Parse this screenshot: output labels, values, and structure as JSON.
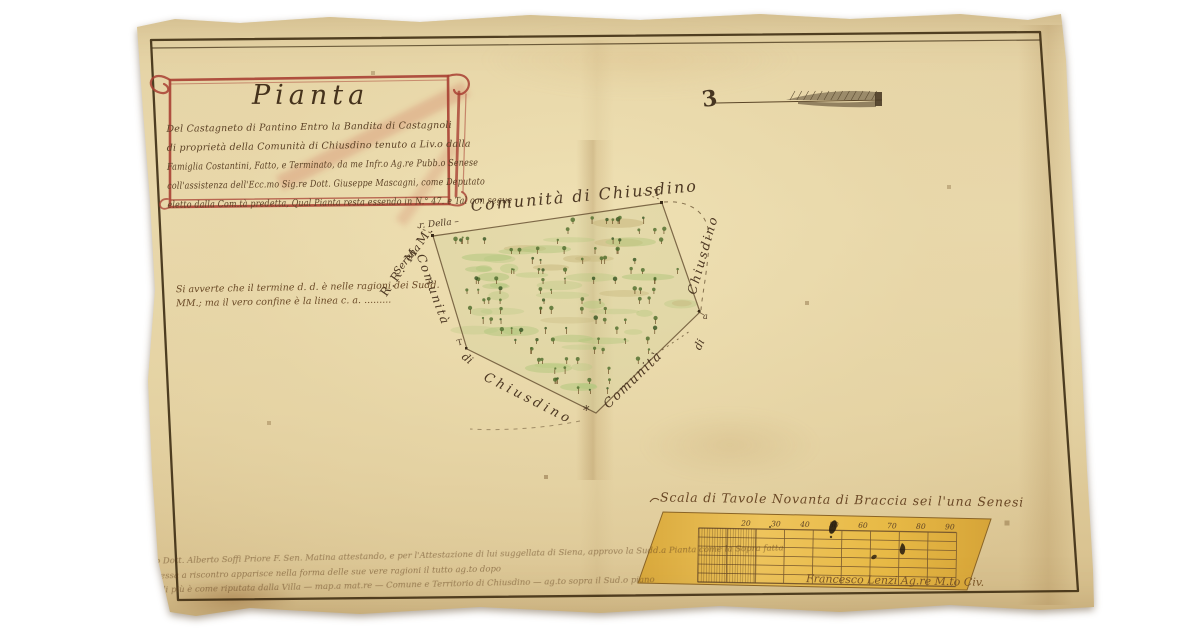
{
  "artifact": {
    "kind": "manuscript cadastral map on parchment",
    "colors": {
      "parchment": "#e6d5a8",
      "ink": "#4a3620",
      "cartouche_red": "#a84033",
      "parcel_green": "#b3c77e",
      "scale_gold": "#e6b844"
    }
  },
  "cartouche": {
    "title": "Pianta",
    "lines": [
      "Del Castagneto di Pantino Entro la Bandita di Castagnoli",
      "di proprietà della Comunità di Chiusdino tenuto a Liv.o dalla",
      "Famiglia Costantini, Fatto, e Terminato, da me Infr.o Ag.re Pubb.o Senese",
      "coll'assistenza dell'Ecc.mo Sig.re Dott. Giuseppe Mascagni, come Deputato",
      "eletto dalla Com.tà predetta, Qual Pianta resta essendo in N.° 47. e Tal con segue"
    ]
  },
  "north_arrow": {
    "glyph": "3"
  },
  "map": {
    "labels": {
      "top": "Comunità di Chiusdino",
      "left": "Comunità",
      "left_di": "di",
      "bottom_left": "Chiusdino",
      "bottom_right": "Comunità",
      "right_di": "di",
      "right": "Chiusdino",
      "neighbor_prefix": "r. Della –",
      "neighbor_name": "Serena",
      "neighbor_initials": "R.R. M.M.",
      "marker_t_top_right": "T",
      "marker_t_bottom_left": "T",
      "marker_star_bottom": "*",
      "marker_a_right": "a"
    }
  },
  "note": {
    "line1": "Si avverte che il termine d. d. è nelle ragioni dei Sudd.",
    "line2": "MM.; ma il vero confine è la linea c. a. ........."
  },
  "scale": {
    "title": "Scala di Tavole Novanta di Braccia sei l'una Senesi",
    "numbers": [
      "20",
      "30",
      "40",
      "50",
      "60",
      "70",
      "80",
      "90"
    ],
    "signature": "Francesco Lenzi Ag.re M.to Civ."
  },
  "attestation": {
    "lines": [
      "Io Dott. Alberto Soffi Priore F. Sen. Matina attestando, e per l'Attestazione di lui suggellata di Siena, approvo la Sudd.a Pianta come la Sopra fatta",
      "messa a riscontro apparisce nella forma delle sue vere ragioni il tutto ag.to dopo",
      "e di più è come riputata dalla Villa — map.a mat.re — Comune e Territorio di Chiusdino — ag.to sopra il Sud.o piano"
    ]
  }
}
